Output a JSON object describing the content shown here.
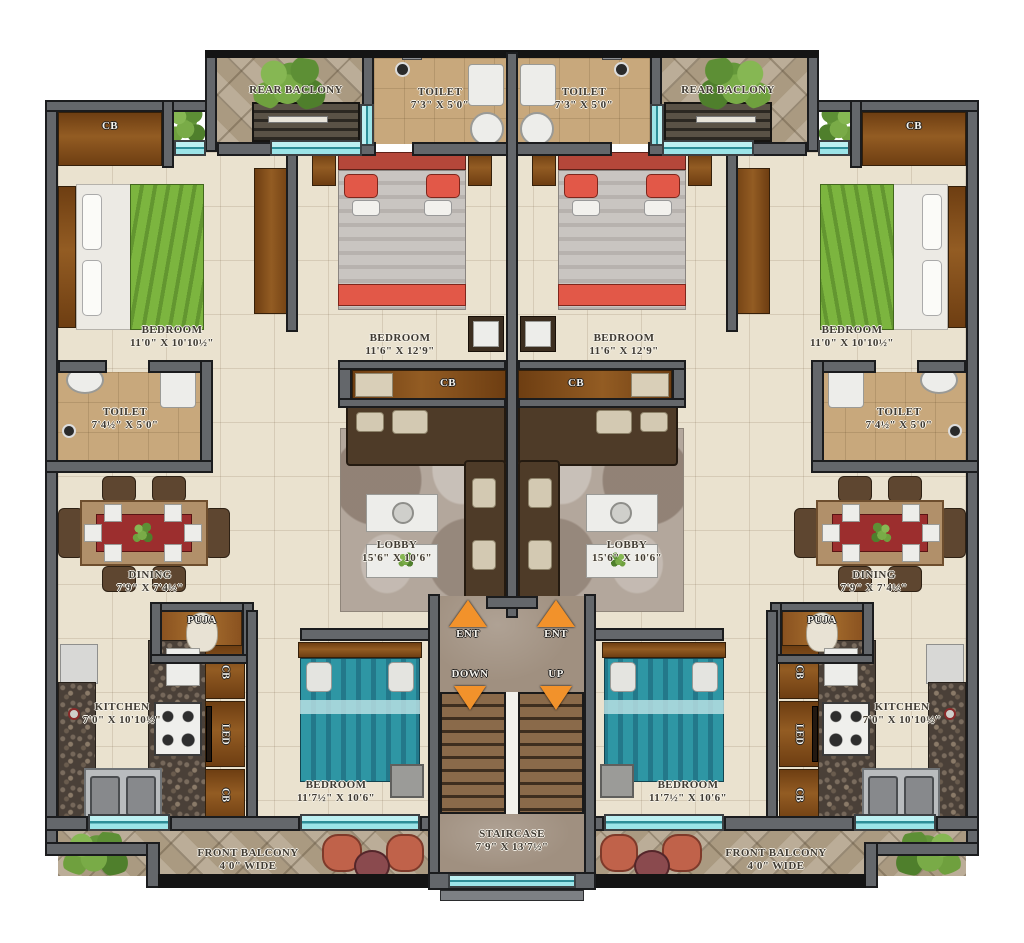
{
  "plan": {
    "rear_balcony": {
      "name": "REAR BACLONY"
    },
    "toilet_top": {
      "name": "TOILET",
      "size": "7'3\" X 5'0\""
    },
    "bedroom_side": {
      "name": "BEDROOM",
      "size": "11'0\" X 10'10½\""
    },
    "bedroom_master": {
      "name": "BEDROOM",
      "size": "11'6\" X 12'9\""
    },
    "toilet_side": {
      "name": "TOILET",
      "size": "7'4½\" X 5'0\""
    },
    "dining": {
      "name": "DINING",
      "size": "7'9\" X 7'4½\""
    },
    "lobby": {
      "name": "LOBBY",
      "size": "15'6\" X 10'6\""
    },
    "puja": {
      "name": "PUJA"
    },
    "kitchen": {
      "name": "KITCHEN",
      "size": "7'0\" X 10'10½\""
    },
    "bedroom_front": {
      "name": "BEDROOM",
      "size": "11'7½\" X 10'6\""
    },
    "front_balcony": {
      "name": "FRONT BALCONY",
      "size": "4'0\" WIDE"
    },
    "staircase": {
      "name": "STAIRCASE",
      "size": "7'9\" X 13'7½\""
    },
    "markers": {
      "ent": "ENT",
      "down": "DOWN",
      "up": "UP",
      "cupboard": "CB",
      "tv": "LED"
    },
    "colors": {
      "wall": "#64676b",
      "floor": "#eae2cf",
      "toilet_floor": "#c8a87c",
      "window": "#9ce4e8",
      "arrow": "#f2922b",
      "wood": "#7a4816",
      "bed_green": "#7cb53f",
      "bed_red": "#e25848",
      "bed_teal": "#2e96a4"
    }
  }
}
